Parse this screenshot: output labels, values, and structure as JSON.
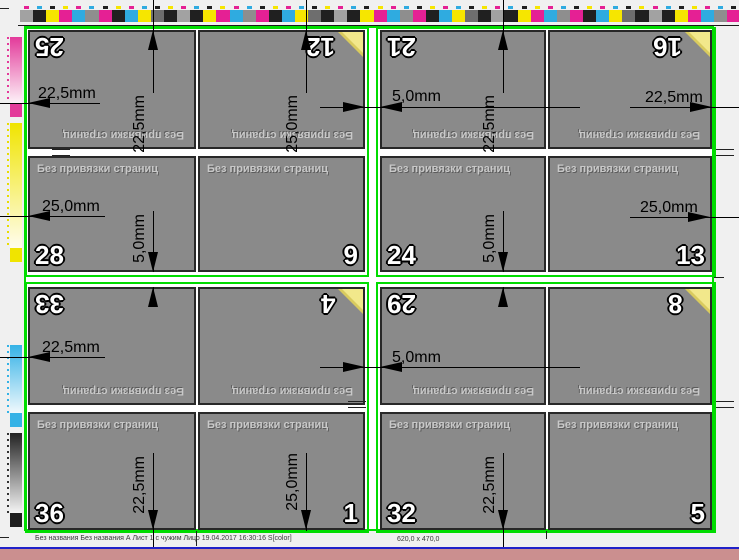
{
  "labels": {
    "no_binding": "Без привязки страниц"
  },
  "dims": {
    "d22_5": "22,5mm",
    "d25_0": "25,0mm",
    "d5_0": "5,0mm"
  },
  "pages": [
    {
      "num": "25"
    },
    {
      "num": "12"
    },
    {
      "num": "21"
    },
    {
      "num": "16"
    },
    {
      "num": "28"
    },
    {
      "num": "9"
    },
    {
      "num": "24"
    },
    {
      "num": "13"
    },
    {
      "num": "33"
    },
    {
      "num": "4"
    },
    {
      "num": "29"
    },
    {
      "num": "8"
    },
    {
      "num": "36"
    },
    {
      "num": "1"
    },
    {
      "num": "32"
    },
    {
      "num": "5"
    }
  ],
  "status_bar": {
    "job_info": "Без названия Без названия  А Лист 1 с чужим Лицо 19.04.2017 16:30:16 S[color]",
    "sheet_size": "620,0 x 470,0"
  },
  "colors": {
    "trim_mark_green": "#00dc00",
    "page_gray": "#8a8a8a",
    "footer_salmon": "#cb8f8f",
    "footer_blue": "#2121c8",
    "triangle_yellow": "#f2e88b"
  },
  "color_bar": {
    "pattern": [
      "#a2a2a2",
      "#202020",
      "#f6e600",
      "#e52094",
      "#2fabe0",
      "#8e8e8e",
      "#e52094",
      "#202020",
      "#2fabe0",
      "#f6e600",
      "#6e6e6e",
      "#202020"
    ],
    "tick_colors": [
      "#e52094",
      "#2fabe0",
      "#202020",
      "#f6e600"
    ]
  },
  "left_strip": {
    "segments": [
      {
        "name": "magenta",
        "color": "#e33a9a"
      },
      {
        "name": "yellow",
        "color": "#f0e400"
      },
      {
        "name": "cyan",
        "color": "#35b2e6"
      },
      {
        "name": "black",
        "color": "#1e1e1e"
      }
    ]
  }
}
